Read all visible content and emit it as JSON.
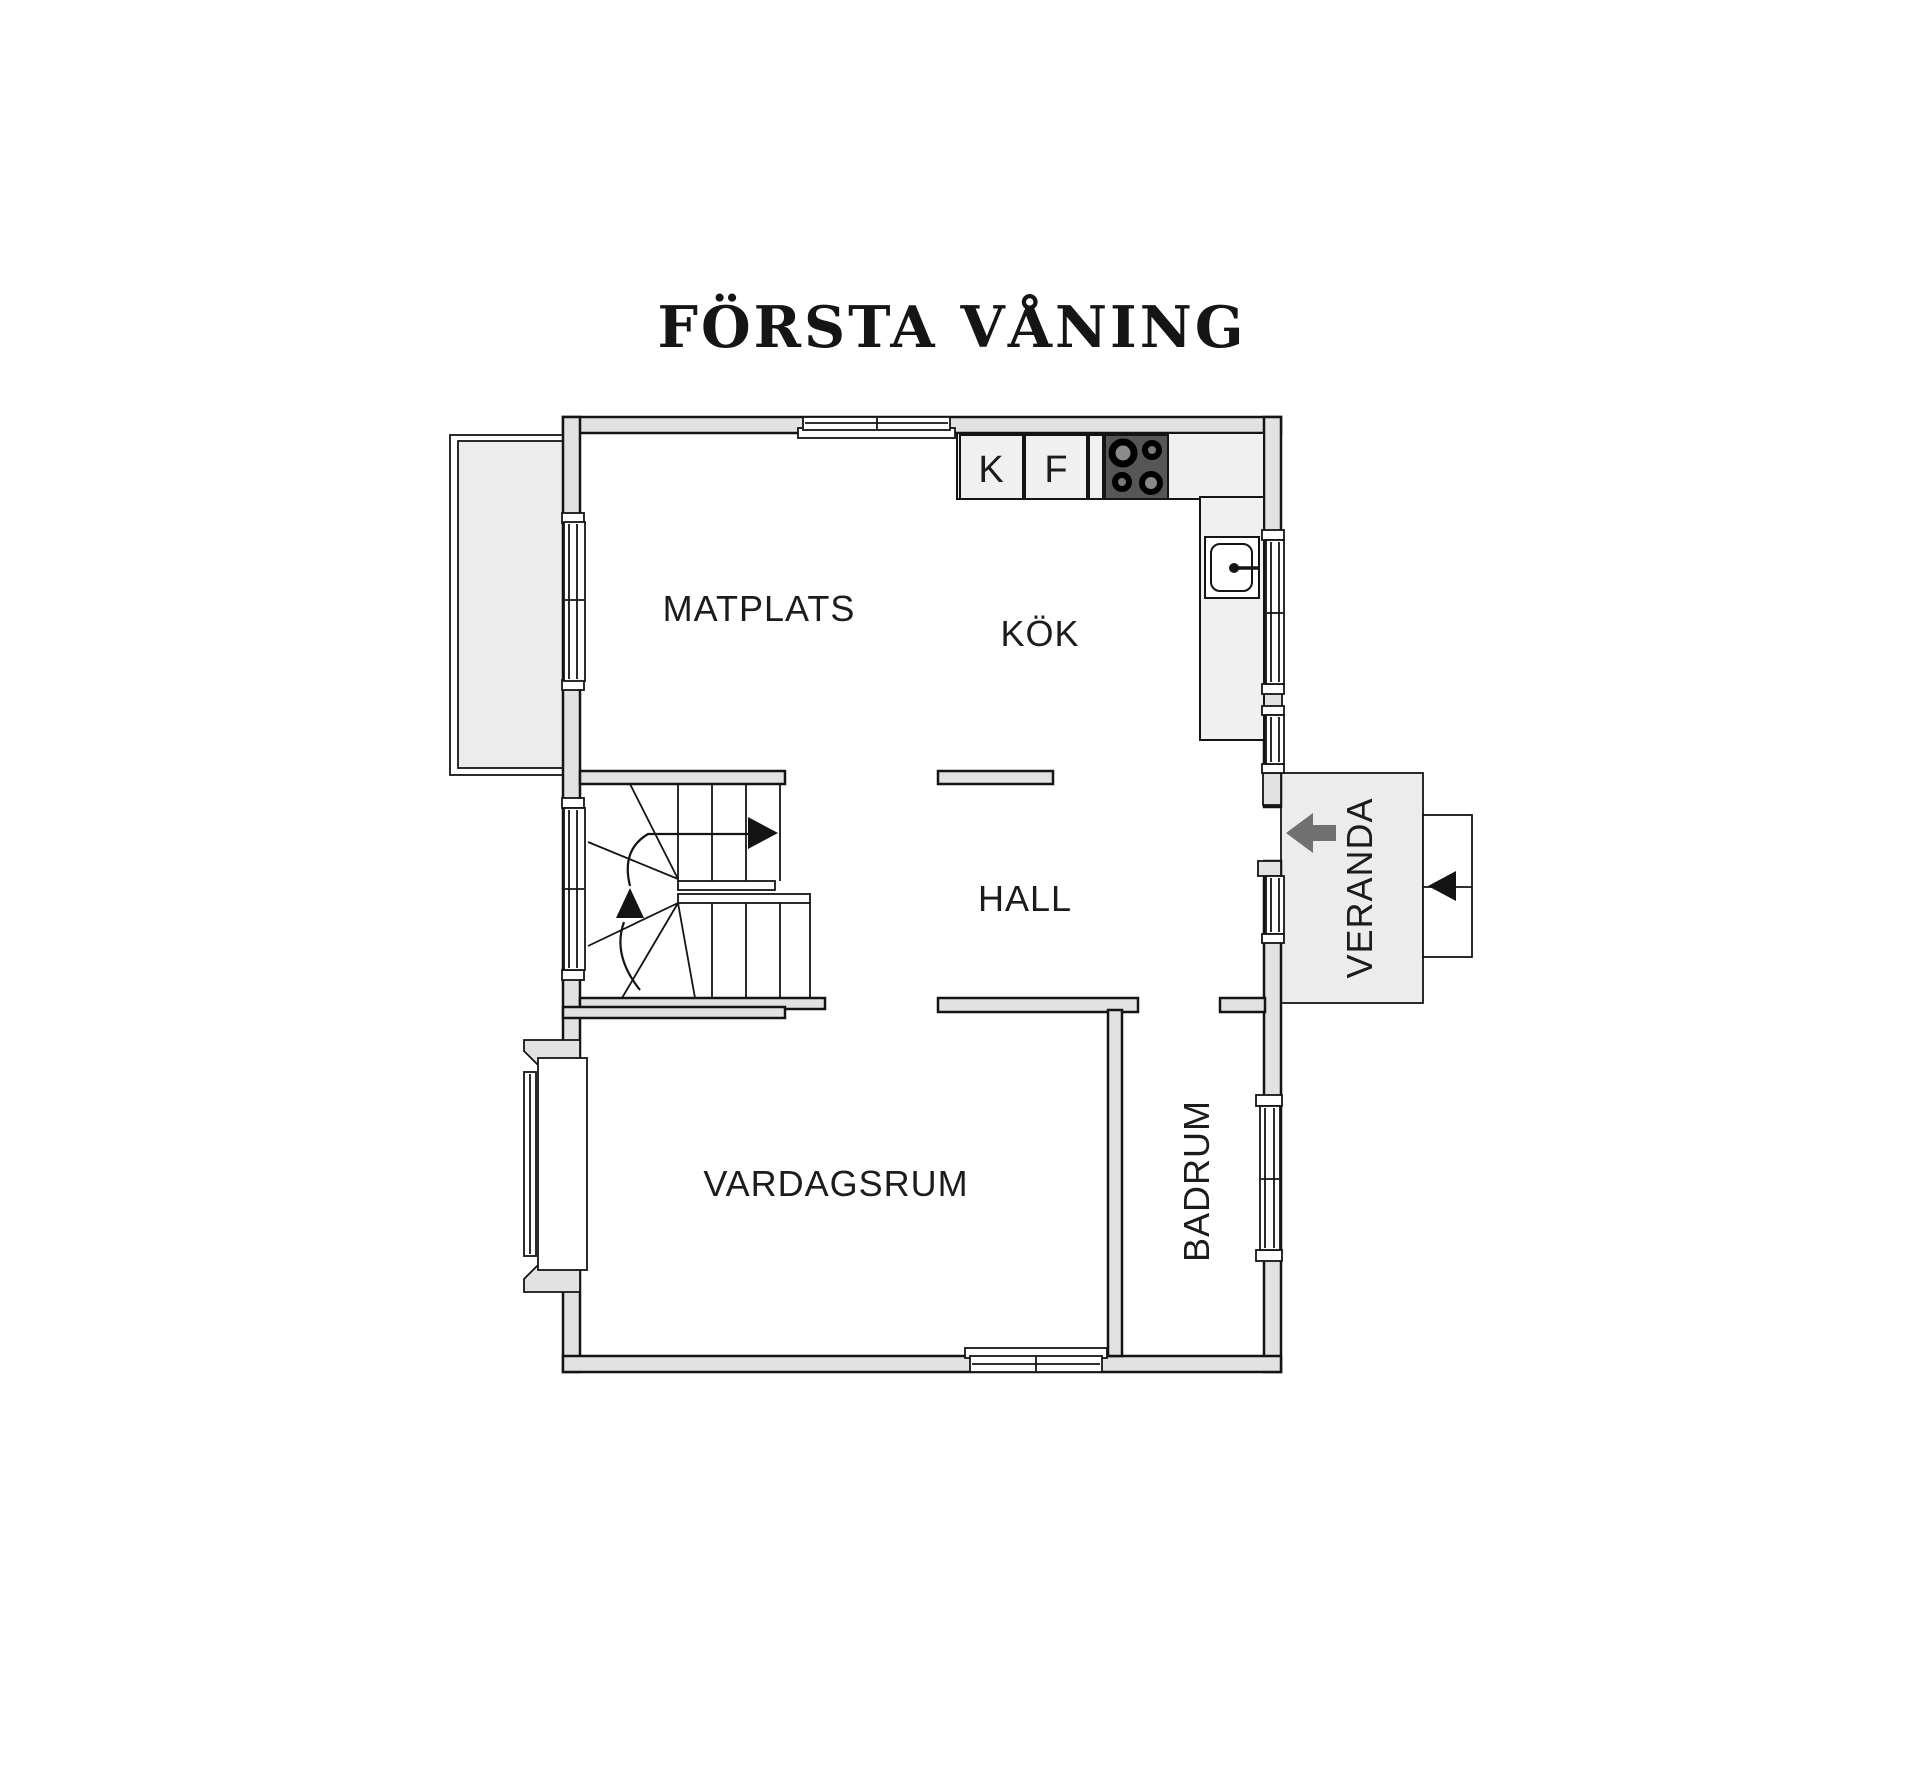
{
  "title": "FÖRSTA VÅNING",
  "rooms": {
    "matplats": "MATPLATS",
    "kok": "KÖK",
    "hall": "HALL",
    "vardagsrum": "VARDAGSRUM",
    "badrum": "BADRUM",
    "veranda": "VERANDA"
  },
  "appliances": {
    "fridge": "K",
    "freezer": "F"
  },
  "colors": {
    "wall_fill": "#e2e2e2",
    "deck_fill": "#ececec",
    "counter_fill": "#f0f0f0",
    "stove_fill": "#565656",
    "arrow_gray": "#707070",
    "line": "#141414",
    "text": "#1c1c1c"
  }
}
